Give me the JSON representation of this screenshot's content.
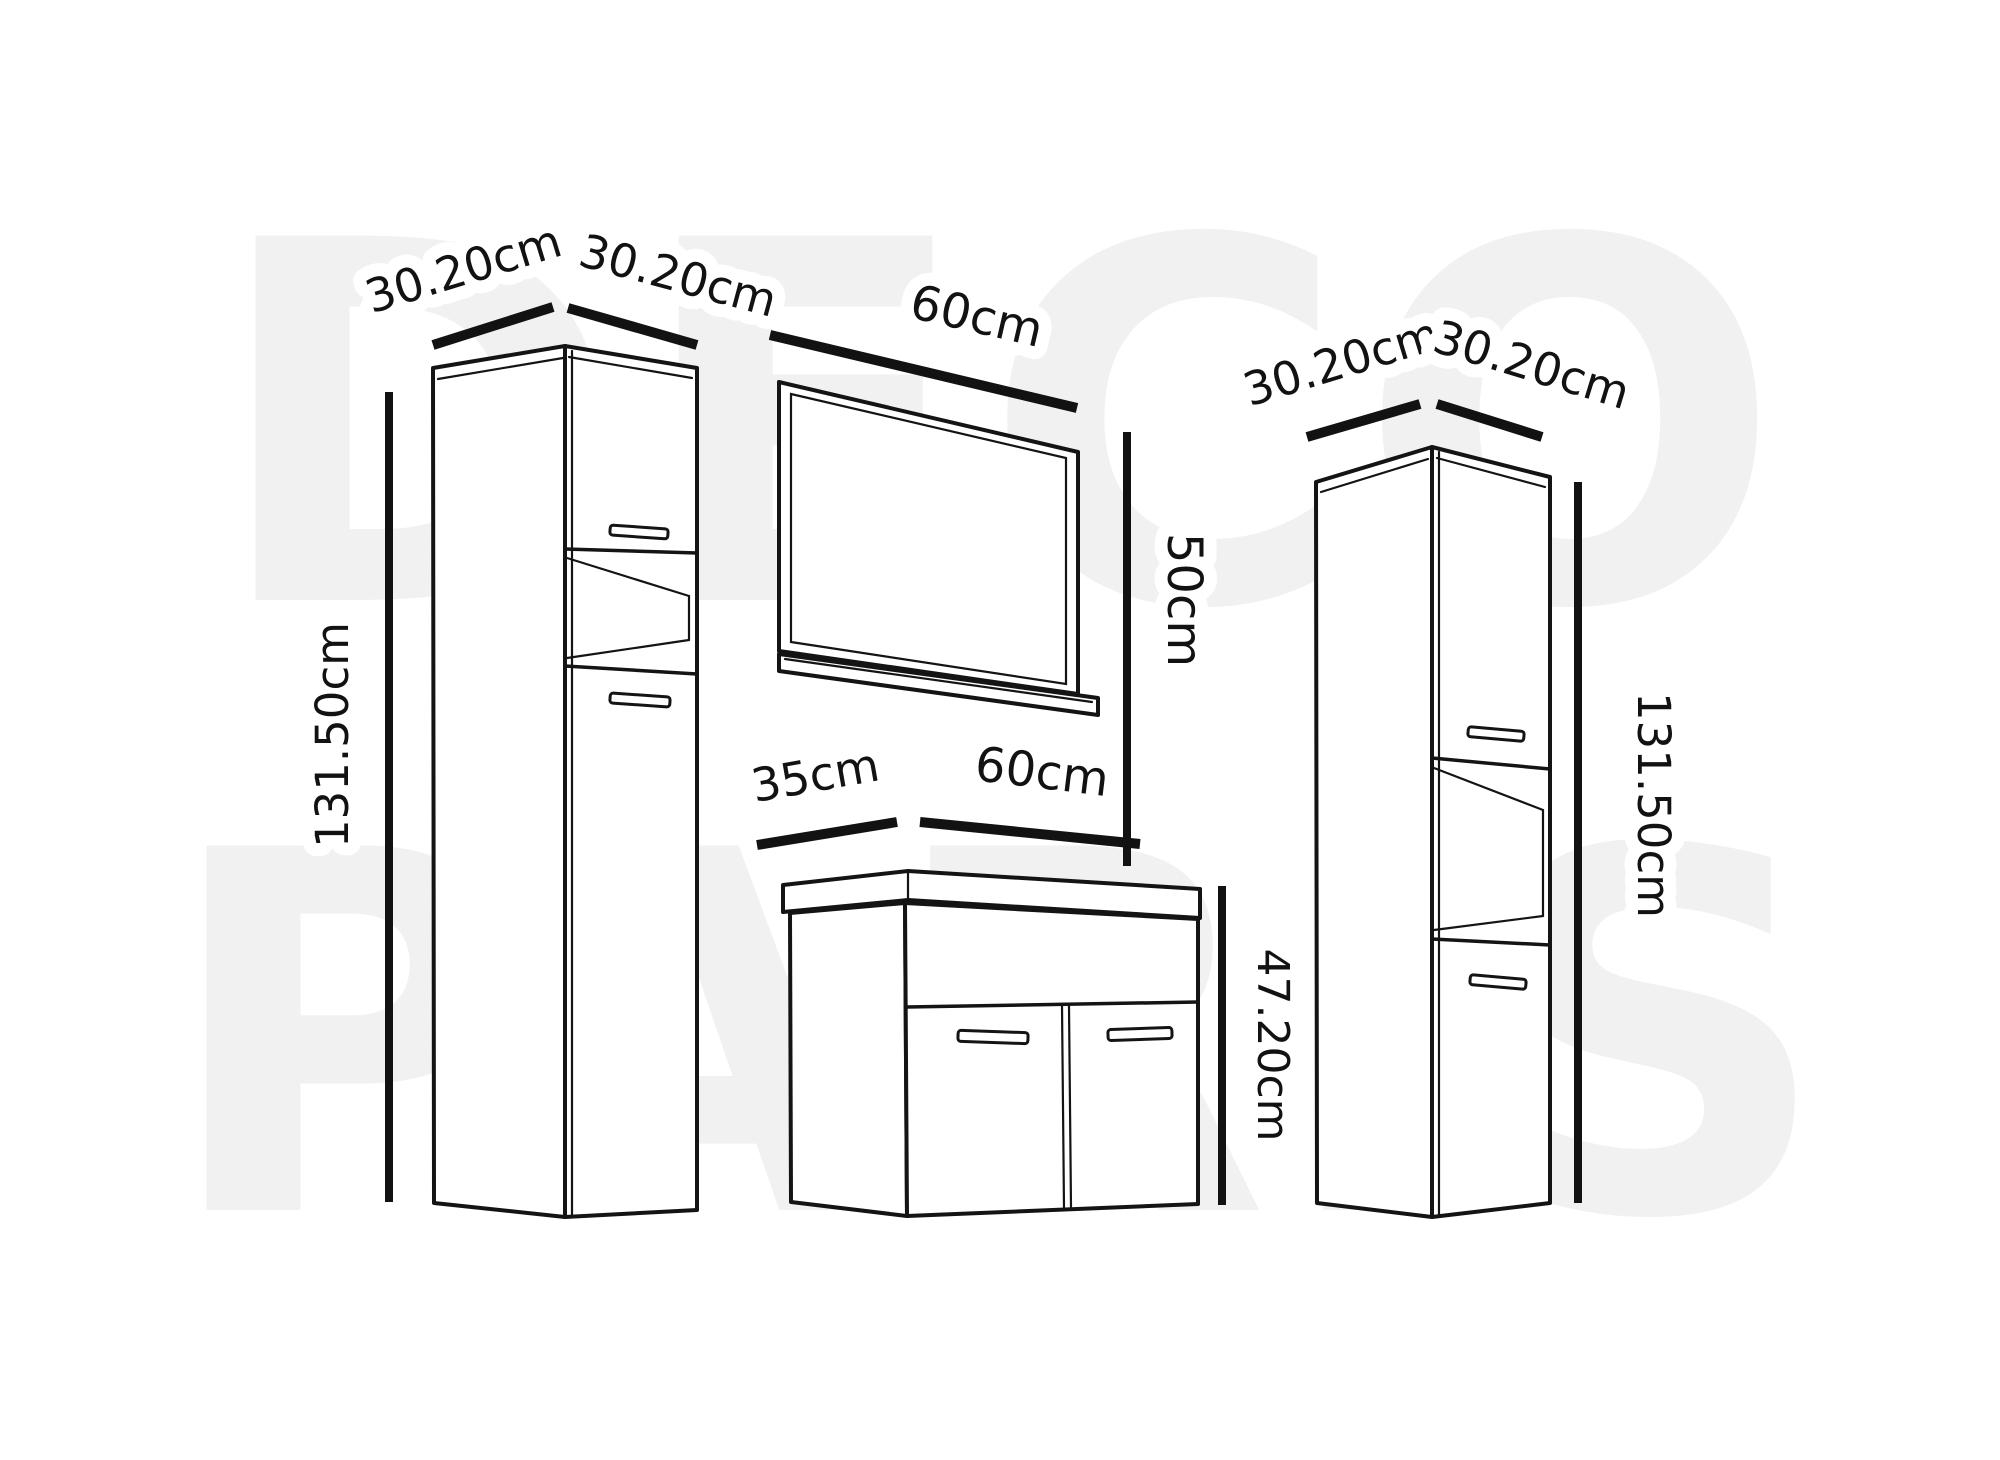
{
  "watermark": {
    "line1": "DECO",
    "line2": "PARIS"
  },
  "left_cabinet": {
    "width_left_label": "30.20cm",
    "width_right_label": "30.20cm",
    "height_label": "131.50cm"
  },
  "mirror": {
    "width_label": "60cm",
    "height_label": "50cm"
  },
  "vanity": {
    "depth_label": "35cm",
    "width_label": "60cm",
    "height_label": "47.20cm"
  },
  "right_cabinet": {
    "width_left_label": "30.20cm",
    "width_right_label": "30.20cm",
    "height_label": "131.50cm"
  },
  "colors": {
    "ink": "#121212",
    "watermark_gray": "#f1f1f1",
    "background": "#ffffff"
  }
}
